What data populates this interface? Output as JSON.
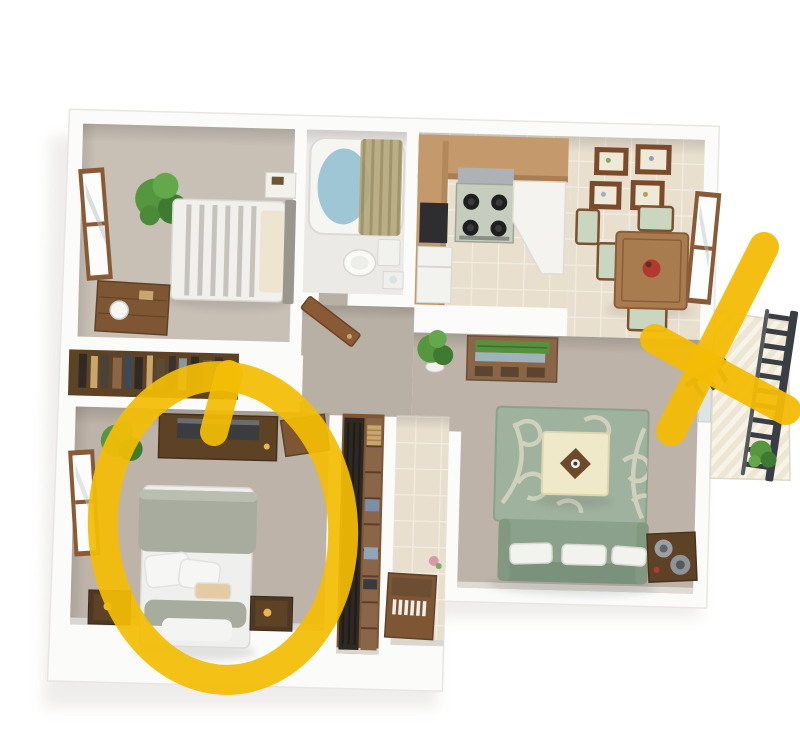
{
  "canvas": {
    "width": 800,
    "height": 750,
    "background": "#FFFFFF"
  },
  "scene": {
    "type": "3d-floorplan-render",
    "rooms": [
      "second-bedroom",
      "bathroom",
      "kitchen",
      "dining-area",
      "living-room",
      "hallway",
      "master-bedroom",
      "walk-in-closet",
      "entry",
      "balcony"
    ],
    "annotations": [
      {
        "shape": "circle",
        "color": "#F3BC05",
        "over": "master-bedroom"
      },
      {
        "shape": "x-mark",
        "color": "#F3BC05",
        "over": "balcony"
      }
    ]
  },
  "colors": {
    "annotation_yellow": "#F3BC05",
    "wall_white": "#FBFBFA",
    "wall_edge": "#E8E6E2",
    "floor_taupe": "#BDB3A8",
    "floor_taupe_light": "#C8C0B5",
    "floor_hall": "#B9B0A5",
    "floor_bath": "#ECEAE6",
    "tile_base": "#E8DFCF",
    "tile_grout": "#F3EDE1",
    "wood_dark": "#5E4226",
    "wood_mid": "#7E5634",
    "wood_frame": "#8A5A36",
    "cabinet_tan": "#C49A6C",
    "sofa_green": "#8CA18C",
    "sofa_green_dark": "#7A917C",
    "rug_green": "#9FB29E",
    "rug_cream": "#D9D6C2",
    "duvet_sage": "#A7AC9E",
    "water_blue": "#9FC6D4",
    "curtain_tan": "#B5A87E",
    "plant_green": "#55963F",
    "plant_green_dark": "#3E7A30",
    "railing_dark": "#3A3E44",
    "tv_black": "#3A3C3E",
    "table_cream": "#EFE8C9",
    "red_accent": "#B03A2E",
    "gold": "#C9A66B",
    "shadow": "#D5D2CC"
  }
}
